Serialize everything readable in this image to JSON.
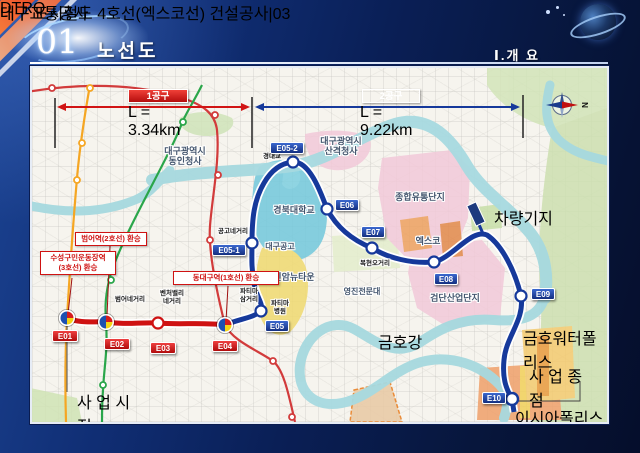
{
  "slide": {
    "number": "01",
    "title": "노선도",
    "section_label": "Ⅰ.개 요",
    "footer": {
      "logo_text": "DTRO",
      "logo_sub": "대구교통공사",
      "doc_title": "대구 도시철도 4호선(엑스코선) 건설공사",
      "separator": "|",
      "page_number": "03"
    }
  },
  "map": {
    "compass": "N",
    "sections": {
      "one": {
        "name": "1공구",
        "length": "L = 3.34km"
      },
      "two": {
        "name": "2공구",
        "length": "L = 9.22km"
      }
    },
    "banners": {
      "start": "사 업 시 점",
      "end": "사 업 종 점"
    },
    "depot": "차량기지",
    "stations": {
      "e01": "E01",
      "e02": "E02",
      "e03": "E03",
      "e04": "E04",
      "e05": "E05",
      "e05_1": "E05-1",
      "e05_2": "E05-2",
      "e06": "E06",
      "e07": "E07",
      "e08": "E08",
      "e09": "E09",
      "e10": "E10"
    },
    "transfers": {
      "beomeo": "범어역(2호선) 환승",
      "suseong_line1": "수성구민운동장역",
      "suseong_line2": "(3호선) 환승",
      "dongdaegu": "동대구역(1호선)  환승"
    },
    "areas": {
      "dongin_line1": "대구광역시",
      "dongin_line2": "동인청사",
      "sangyeok_line1": "대구광역시",
      "sangyeok_line2": "산격청사",
      "knu": "경북대학교",
      "distribution": "종합유통단지",
      "exco": "엑스코",
      "geomdan": "검단산업단지",
      "sinam": "신암뉴타운",
      "yeongjin": "영진전문대",
      "daegu_tech_hs": "대구공고",
      "kumho_water_polis": "금호워터폴리스",
      "isia_polis": "이시아폴리스"
    },
    "roads": {
      "gyeongdae_bridge": "경대교",
      "gonggo": "공고네거리",
      "beomeo": "범어네거리",
      "venture_line1": "벤처밸리",
      "venture_line2": "네거리",
      "fatima_sam_line1": "파티마",
      "fatima_sam_line2": "삼거리",
      "fatima_hosp_line1": "파티마",
      "fatima_hosp_line2": "병원",
      "bokhyeon": "복현오거리"
    },
    "river": {
      "ch1": "금",
      "ch2": "호",
      "ch3": "강"
    },
    "colors": {
      "section1_red": "#cf1212",
      "section2_blue": "#16399b",
      "line1": "#d23b3b",
      "line2": "#2aa64a",
      "line3": "#f5a623",
      "river": "#a6d9df"
    }
  }
}
